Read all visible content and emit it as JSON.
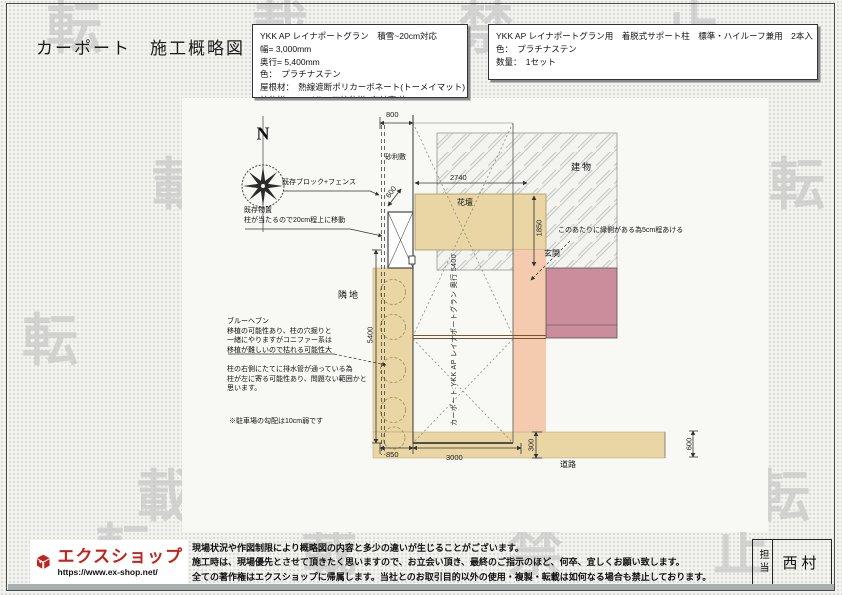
{
  "page": {
    "title": "カーポート　施工概略図"
  },
  "watermark": {
    "text": "転載禁止"
  },
  "product_box": {
    "lines": [
      "YKK AP レイナポートグラン　積雪~20cm対応",
      "幅= 3,000mm",
      "奥行= 5,400mm",
      "色：　プラチナステン",
      "屋根材：　熱線遮断ポリカーボネート(トーメイマット)",
      "柱仕様：　ハイルーフ柱仕様 (有効高 約2,350mm)"
    ]
  },
  "support_box": {
    "lines": [
      "YKK AP レイナポートグラン用　着脱式サポート柱　標準・ハイルーフ兼用　2本入",
      "色：　プラチナステン",
      "数量：　1セット"
    ]
  },
  "drawing": {
    "compass_n": "N",
    "labels": {
      "gravel": "砂利敷",
      "building": "建物",
      "flowerbed": "花壇",
      "entrance": "玄関",
      "neighbor": "隣地",
      "road": "道路",
      "carport_vertical": "カーポート:YKK AP レイナポートグラン 奥行 5400"
    },
    "dimensions": {
      "top_800": "800",
      "width_2740": "2740",
      "gravel_600": "600",
      "entry_1850": "1850",
      "depth_5400": "5400",
      "left_850": "850",
      "center_3000": "3000",
      "step_300": "300",
      "road_600": "600"
    },
    "annotations": {
      "fence": "既存ブロック+フェンス",
      "shed1": "既存物置",
      "shed2": "柱が当たるので20cm程上に移動",
      "tree1": "ブルーヘブン",
      "tree2": "移植の可能性あり、柱の穴掘りと",
      "tree3": "一緒にやりますがコニファー系は",
      "tree4": "移植が難しいので枯れる可能性大",
      "pipe1": "柱の右側にたてに排水管が通っている為",
      "pipe2": "柱が左に寄る可能性あり、問題ない範囲かと",
      "pipe3": "思います。",
      "slope": "※駐車場の勾配は10cm弱です",
      "veranda": "このあたりに縁側がある為5cm程あける"
    }
  },
  "footer": {
    "brand": "エクスショップ",
    "url": "https://www.ex-shop.net/",
    "disclaimer1": "現場状況や作図制限により概略図の内容と多少の違いが生じることがございます。",
    "disclaimer2": "施工時は、現場優先とさせて頂きたく思いますので、お立会い頂き、最終のご指示のほど、何卒、宜しくお願い致します。",
    "disclaimer3": "全ての著作権はエクスショップに帰属します。当社とのお取引目的以外の使用・複製・転載は如何なる場合も禁止しております。",
    "person_label": "担当",
    "person_name": "西村"
  },
  "colors": {
    "accent_red": "#c0251c",
    "flowerbed_tan": "#e9d6a4",
    "approach_salmon": "#f4cbaf",
    "porch_pink": "#cb8d9b",
    "watermark_gray": "#bdbdbb"
  }
}
